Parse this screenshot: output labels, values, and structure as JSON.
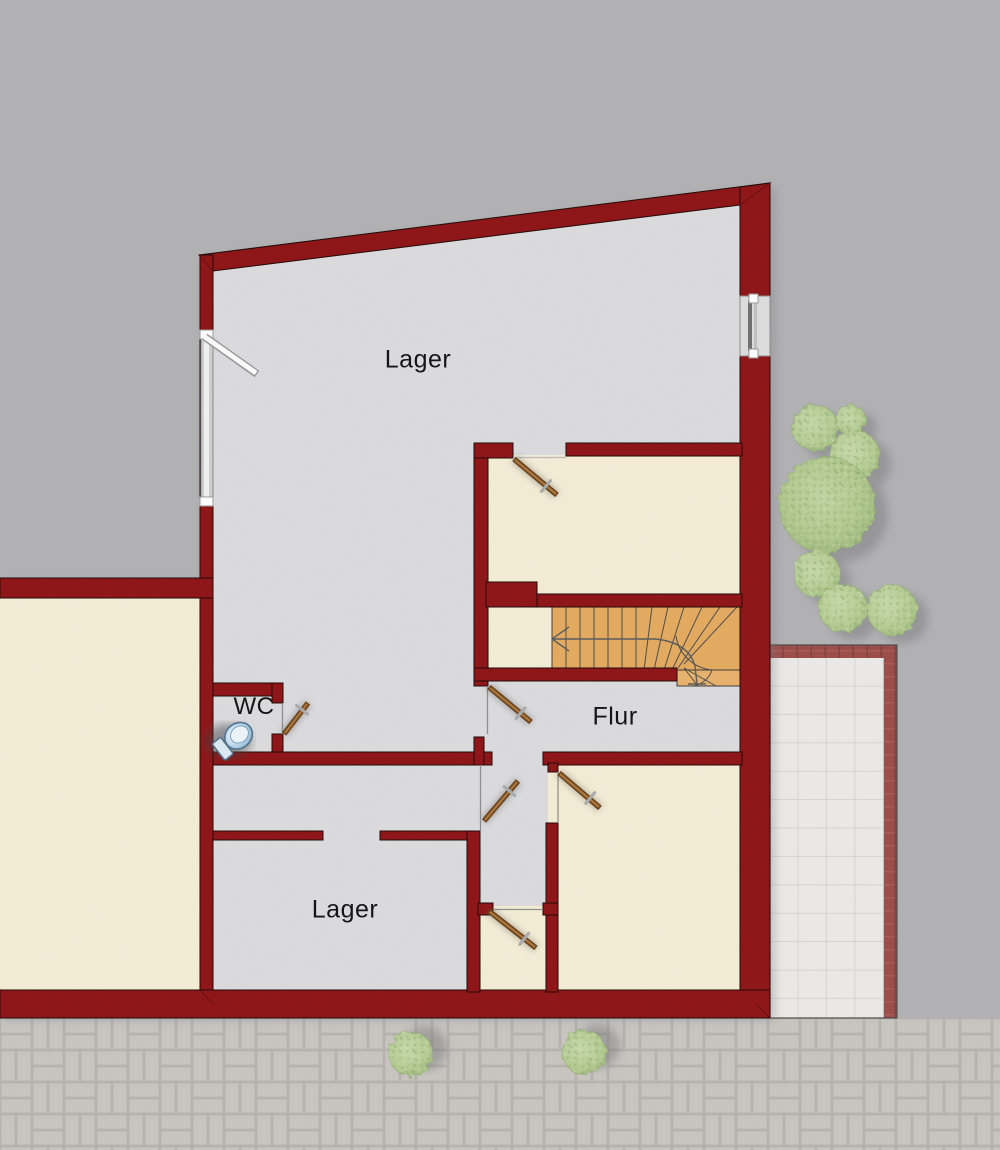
{
  "plan": {
    "type": "floor-plan",
    "language": "de",
    "rooms": [
      {
        "id": "lager-top",
        "label": "Lager"
      },
      {
        "id": "wc",
        "label": "WC"
      },
      {
        "id": "flur",
        "label": "Flur"
      },
      {
        "id": "lager-bottom",
        "label": "Lager"
      }
    ],
    "icons": [
      "toilet-icon",
      "stairs-icon",
      "door-icon",
      "window-icon",
      "tree-icon",
      "bush-icon"
    ],
    "colors": {
      "wall": "#8e1214",
      "floor_gray": "#dcdcde",
      "floor_beige": "#f5eed6",
      "stairs_orange": "#e5aa5e",
      "background_gray": "#b2b2b4",
      "cobblestone": "#c9c6c1",
      "patio_tile": "#ecebe9",
      "patio_border": "#9c4b48",
      "tree_green": "#b7cf97",
      "door_leaf": "#8a5526",
      "toilet_blue": "#cfe3f2"
    }
  }
}
